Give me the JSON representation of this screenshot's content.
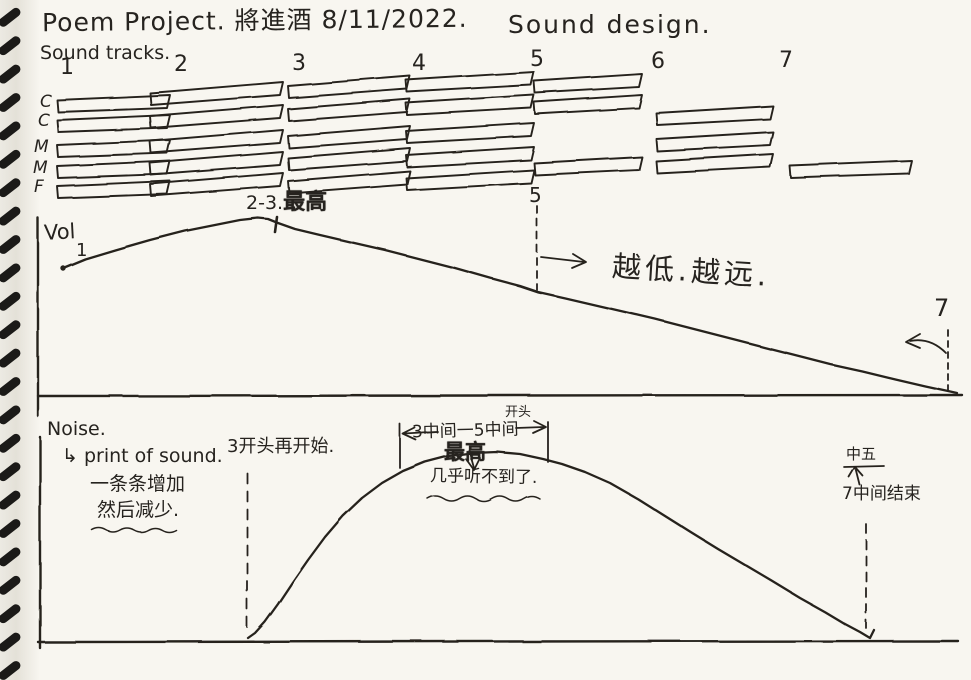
{
  "colors": {
    "ink": "#26231f",
    "paper": "#f8f6f0",
    "spiral": "#1b1a18"
  },
  "header": {
    "title_left": "Poem Project. 將進酒  8/11/2022.",
    "title_right": "Sound design.",
    "subtitle": "Sound tracks."
  },
  "tracks": {
    "numbers": [
      "1",
      "2",
      "3",
      "4",
      "5",
      "6",
      "7"
    ],
    "row_labels": [
      "C",
      "C",
      "M",
      "M",
      "F"
    ]
  },
  "vol_chart": {
    "axis_label": "Vol",
    "start_label": "1",
    "peak_prefix": "2-3.",
    "peak_word": "最高",
    "marker5": "5",
    "marker7": "7",
    "fade_note": "越低.越远."
  },
  "noise_chart": {
    "heading": "Noise.",
    "line1": "↳ print of sound.",
    "line2": "一条条增加",
    "line3": "然后减少.",
    "restart_note": "3开头再开始.",
    "range_note": "3中间一5中间",
    "range_sup": "开头",
    "peak_note": "最高",
    "inaudible_note": "几乎听不到了.",
    "end_label": "中五",
    "end_note": "7中间结束"
  },
  "sketch": {
    "spiral": {
      "count": 24,
      "start": 17,
      "gap": 28.4
    },
    "bar_height": 13,
    "bars": [
      [
        57,
        100,
        113,
        5
      ],
      [
        57,
        120,
        113,
        5
      ],
      [
        57,
        145,
        113,
        5
      ],
      [
        57,
        166,
        113,
        5
      ],
      [
        57,
        186,
        113,
        5
      ],
      [
        150,
        93,
        133,
        11
      ],
      [
        150,
        116,
        133,
        11
      ],
      [
        150,
        141,
        133,
        11
      ],
      [
        150,
        163,
        133,
        11
      ],
      [
        150,
        184,
        133,
        11
      ],
      [
        288,
        86,
        122,
        10
      ],
      [
        288,
        109,
        122,
        10
      ],
      [
        288,
        136,
        122,
        10
      ],
      [
        288,
        158,
        122,
        10
      ],
      [
        288,
        181,
        122,
        10
      ],
      [
        406,
        80,
        128,
        8
      ],
      [
        406,
        103,
        128,
        8
      ],
      [
        406,
        131,
        128,
        8
      ],
      [
        406,
        155,
        128,
        8
      ],
      [
        406,
        178,
        128,
        8
      ],
      [
        534,
        81,
        108,
        7
      ],
      [
        534,
        102,
        108,
        7
      ],
      [
        534,
        163,
        108,
        6
      ],
      [
        656,
        113,
        117,
        7
      ],
      [
        656,
        139,
        117,
        7
      ],
      [
        656,
        161,
        117,
        7
      ],
      [
        790,
        166,
        122,
        5
      ]
    ],
    "vol_curve": [
      [
        63,
        268
      ],
      [
        85,
        259
      ],
      [
        115,
        250
      ],
      [
        150,
        240
      ],
      [
        185,
        231
      ],
      [
        215,
        225
      ],
      [
        240,
        220
      ],
      [
        258,
        218
      ],
      [
        268,
        219
      ],
      [
        278,
        223
      ],
      [
        295,
        229
      ],
      [
        320,
        235
      ],
      [
        350,
        242
      ],
      [
        385,
        250
      ],
      [
        420,
        259
      ],
      [
        455,
        268
      ],
      [
        490,
        278
      ],
      [
        520,
        286
      ],
      [
        538,
        292
      ],
      [
        565,
        298
      ],
      [
        595,
        305
      ],
      [
        625,
        312
      ],
      [
        655,
        319
      ],
      [
        690,
        328
      ],
      [
        725,
        337
      ],
      [
        760,
        346
      ],
      [
        795,
        355
      ],
      [
        830,
        364
      ],
      [
        862,
        371
      ],
      [
        895,
        379
      ],
      [
        925,
        386
      ],
      [
        948,
        391
      ],
      [
        957,
        393
      ]
    ],
    "noise_curve": [
      [
        248,
        638
      ],
      [
        255,
        633
      ],
      [
        265,
        622
      ],
      [
        278,
        604
      ],
      [
        292,
        583
      ],
      [
        308,
        560
      ],
      [
        325,
        537
      ],
      [
        343,
        516
      ],
      [
        362,
        498
      ],
      [
        382,
        483
      ],
      [
        403,
        471
      ],
      [
        425,
        462
      ],
      [
        448,
        456
      ],
      [
        472,
        453
      ],
      [
        497,
        452
      ],
      [
        520,
        454
      ],
      [
        543,
        459
      ],
      [
        562,
        464
      ],
      [
        585,
        472
      ],
      [
        610,
        483
      ],
      [
        638,
        499
      ],
      [
        665,
        516
      ],
      [
        692,
        533
      ],
      [
        718,
        549
      ],
      [
        745,
        565
      ],
      [
        772,
        581
      ],
      [
        800,
        598
      ],
      [
        825,
        612
      ],
      [
        845,
        624
      ],
      [
        860,
        632
      ],
      [
        870,
        638
      ],
      [
        874,
        630
      ]
    ]
  }
}
